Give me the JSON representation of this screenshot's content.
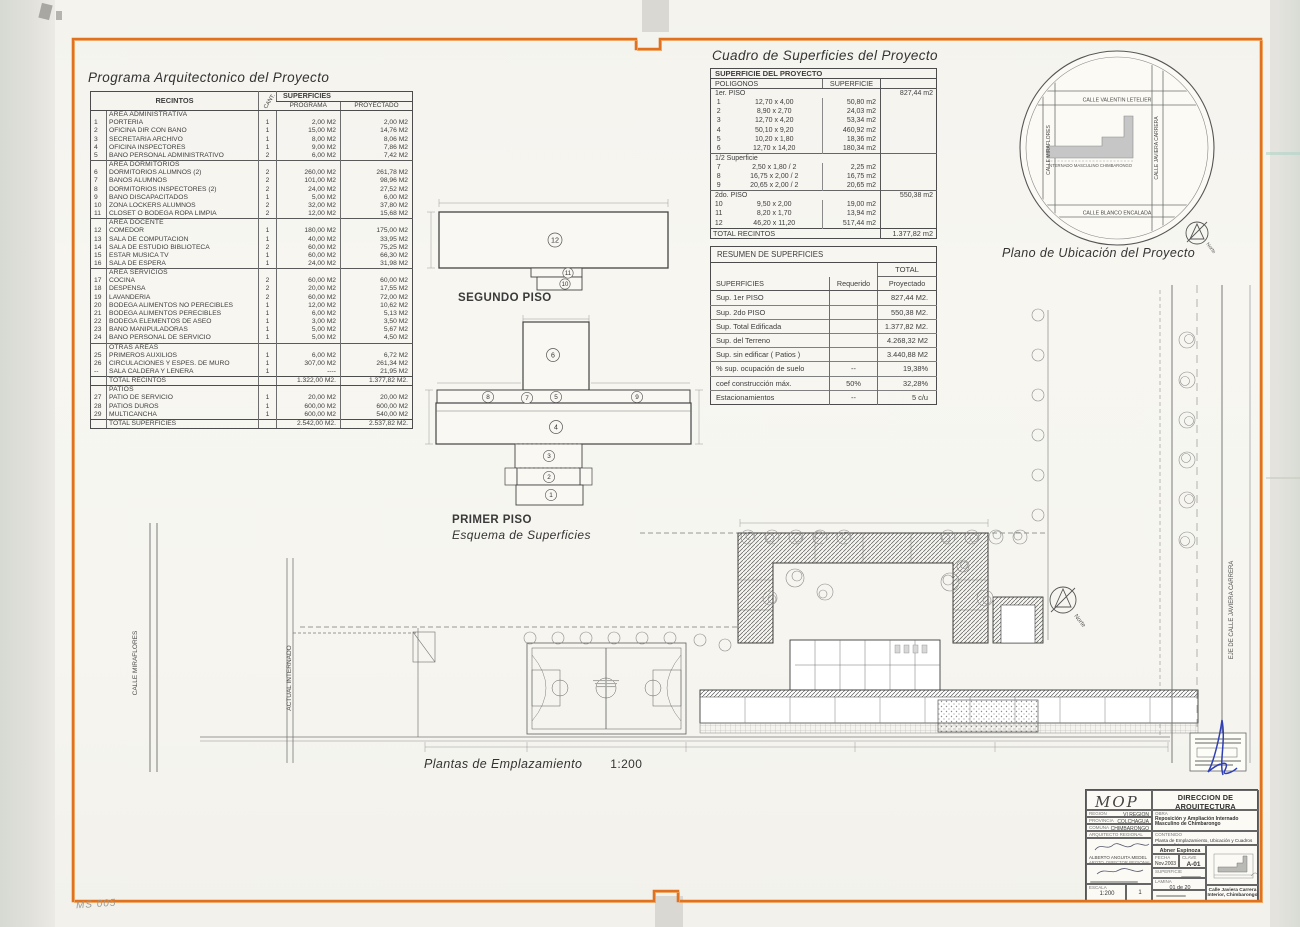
{
  "page": {
    "handwritten_mark": "MS 005"
  },
  "programa": {
    "title": "Programa Arquitectonico del Proyecto",
    "headers": {
      "recintos": "RECINTOS",
      "cant": "CANT.",
      "superficies": "SUPERFICIES",
      "programa": "PROGRAMA",
      "proyectado": "PROYECTADO"
    },
    "blocks": [
      {
        "name": "AREA ADMINISTRATIVA",
        "rows": [
          [
            "1",
            "PORTERIA",
            "1",
            "2,00 M2",
            "2,00 M2"
          ],
          [
            "2",
            "OFICINA DIR CON BAÑO",
            "1",
            "15,00 M2",
            "14,76 M2"
          ],
          [
            "3",
            "SECRETARIA ARCHIVO",
            "1",
            "8,00 M2",
            "8,06 M2"
          ],
          [
            "4",
            "OFICINA INSPECTORES",
            "1",
            "9,00 M2",
            "7,86 M2"
          ],
          [
            "5",
            "BAÑO PERSONAL ADMINISTRATIVO",
            "2",
            "6,00 M2",
            "7,42 M2"
          ]
        ]
      },
      {
        "name": "AREA DORMITORIOS",
        "rows": [
          [
            "6",
            "DORMITORIOS ALUMNOS  (2)",
            "2",
            "260,00 M2",
            "261,78 M2"
          ],
          [
            "7",
            "BAÑOS ALUMNOS",
            "2",
            "101,00 M2",
            "98,96 M2"
          ],
          [
            "8",
            "DORMITORIOS INSPECTORES  (2)",
            "2",
            "24,00 M2",
            "27,52 M2"
          ],
          [
            "9",
            "BAÑO DISCAPACITADOS",
            "1",
            "5,00 M2",
            "6,00 M2"
          ],
          [
            "10",
            "ZONA LOCKERS ALUMNOS",
            "2",
            "32,00 M2",
            "37,80 M2"
          ],
          [
            "11",
            "CLOSET O BODEGA ROPA LIMPIA",
            "2",
            "12,00 M2",
            "15,68 M2"
          ]
        ]
      },
      {
        "name": "AREA DOCENTE",
        "rows": [
          [
            "12",
            "COMEDOR",
            "1",
            "180,00 M2",
            "175,00 M2"
          ],
          [
            "13",
            "SALA DE COMPUTACION",
            "1",
            "40,00 M2",
            "33,95 M2"
          ],
          [
            "14",
            "SALA DE ESTUDIO BIBLIOTECA",
            "2",
            "60,00 M2",
            "75,25 M2"
          ],
          [
            "15",
            "ESTAR MUSICA TV",
            "1",
            "60,00 M2",
            "66,30 M2"
          ],
          [
            "16",
            "SALA DE ESPERA",
            "1",
            "24,00 M2",
            "31,98 M2"
          ]
        ]
      },
      {
        "name": "AREA SERVICIOS",
        "rows": [
          [
            "17",
            "COCINA",
            "2",
            "60,00 M2",
            "60,00 M2"
          ],
          [
            "18",
            "DESPENSA",
            "2",
            "20,00 M2",
            "17,55 M2"
          ],
          [
            "19",
            "LAVANDERIA",
            "2",
            "60,00 M2",
            "72,00 M2"
          ],
          [
            "20",
            "BODEGA ALIMENTOS NO PERECIBLES",
            "1",
            "12,00 M2",
            "10,62 M2"
          ],
          [
            "21",
            "BODEGA ALIMENTOS PERECIBLES",
            "1",
            "6,00 M2",
            "5,13 M2"
          ],
          [
            "22",
            "BODEGA ELEMENTOS DE ASEO",
            "1",
            "3,00 M2",
            "3,50 M2"
          ],
          [
            "23",
            "BAÑO MANIPULADORAS",
            "1",
            "5,00 M2",
            "5,67 M2"
          ],
          [
            "24",
            "BAÑO PERSONAL DE SERVICIO",
            "1",
            "5,00 M2",
            "4,50 M2"
          ]
        ]
      },
      {
        "name": "OTRAS AREAS",
        "rows": [
          [
            "25",
            "PRIMEROS AUXILIOS",
            "1",
            "6,00 M2",
            "6,72 M2"
          ],
          [
            "26",
            "CIRCULACIONES Y ESPES. DE MURO",
            "1",
            "307,00 M2",
            "261,34 M2"
          ],
          [
            "--",
            "SALA CALDERA Y LEÑERA",
            "1",
            "----",
            "21,95 M2"
          ]
        ]
      },
      {
        "label": "TOTAL RECINTOS",
        "programa": "1.322,00 M2.",
        "proyectado": "1.377,82 M2."
      },
      {
        "name": "PATIOS",
        "rows": [
          [
            "27",
            "PATIO DE SERVICIO",
            "1",
            "20,00 M2",
            "20,00 M2"
          ],
          [
            "28",
            "PATIOS DUROS",
            "1",
            "600,00 M2",
            "600,00 M2"
          ],
          [
            "29",
            "MULTICANCHA",
            "1",
            "600,00 M2",
            "540,00 M2"
          ]
        ]
      },
      {
        "label": "TOTAL SUPERFICIES",
        "programa": "2.542,00 M2.",
        "proyectado": "2.537,82 M2."
      }
    ]
  },
  "cuadro": {
    "title": "Cuadro de Superficies del Proyecto",
    "table_title": "SUPERFICIE DEL PROYECTO",
    "col_poligonos": "POLIGONOS",
    "col_superficie": "SUPERFICIE",
    "groups": [
      {
        "name": "1er.  PISO",
        "total": "827,44 m2",
        "rows": [
          [
            "1",
            "12,70 x 4,00",
            "50,80 m2"
          ],
          [
            "2",
            "8,90 x 2,70",
            "24,03 m2"
          ],
          [
            "3",
            "12,70 x 4,20",
            "53,34 m2"
          ],
          [
            "4",
            "50,10 x 9,20",
            "460,92 m2"
          ],
          [
            "5",
            "10,20 x 1,80",
            "18,36 m2"
          ],
          [
            "6",
            "12,70 x 14,20",
            "180,34 m2"
          ]
        ]
      },
      {
        "name": "1/2 Superficie",
        "total": "",
        "rows": [
          [
            "7",
            "2,50 x 1,80 / 2",
            "2,25 m2"
          ],
          [
            "8",
            "16,75 x 2,00 / 2",
            "16,75 m2"
          ],
          [
            "9",
            "20,65 x 2,00 / 2",
            "20,65 m2"
          ]
        ]
      },
      {
        "name": "2do.  PISO",
        "total": "550,38 m2",
        "rows": [
          [
            "10",
            "9,50 x 2,00",
            "19,00 m2"
          ],
          [
            "11",
            "8,20 x 1,70",
            "13,94 m2"
          ],
          [
            "12",
            "46,20 x 11,20",
            "517,44 m2"
          ]
        ]
      }
    ],
    "total": {
      "label": "TOTAL RECINTOS",
      "value": "1.377,82 m2"
    }
  },
  "resumen": {
    "title": "RESUMEN DE SUPERFICIES",
    "total_header": "TOTAL",
    "col_superficies": "SUPERFICIES",
    "col_requerido": "Requerido",
    "col_proyectado": "Proyectado",
    "rows": [
      [
        "Sup. 1er PISO",
        "",
        "827,44 M2."
      ],
      [
        "Sup. 2do PISO",
        "",
        "550,38 M2."
      ],
      [
        "Sup. Total Edificada",
        "",
        "1.377,82 M2."
      ],
      [
        "Sup. del Terreno",
        "",
        "4.268,32 M2"
      ],
      [
        "Sup. sin edificar ( Patios )",
        "",
        "3.440,88 M2"
      ],
      [
        "% sup. ocupación de suelo",
        "--",
        "19,38%"
      ],
      [
        "coef construcción máx.",
        "50%",
        "32,28%"
      ],
      [
        "Estacionamientos",
        "--",
        "5 c/u"
      ]
    ]
  },
  "ubicacion": {
    "label": "Plano de Ubicación del Proyecto",
    "street_top": "CALLE  VALENTIN LETELIER",
    "street_bottom": "CALLE  BLANCO ENCALADA",
    "street_left": "CALLE  MIRAFLORES",
    "street_right": "CALLE  JAVIERA CARRERA",
    "building_label": "INTERNADO MASCULINO CHIMBARONGO",
    "north_label": "Norte"
  },
  "esquemas": {
    "segundo_piso": {
      "label": "SEGUNDO PISO",
      "numbers": [
        "12",
        "11",
        "10"
      ]
    },
    "primer_piso": {
      "label": "PRIMER PISO",
      "sublabel": "Esquema de Superficies",
      "numbers": [
        "6",
        "8",
        "7",
        "5",
        "9",
        "4",
        "3",
        "2",
        "1"
      ]
    }
  },
  "emplazamiento": {
    "label": "Plantas de Emplazamiento",
    "scale": "1:200",
    "calle_miraflores": "CALLE MIRAFLORES",
    "actual_internado": "ACTUAL INTERNADO",
    "eje_calle": "EJE DE CALLE JAVIERA CARRERA",
    "north_label": "Norte"
  },
  "titleblock": {
    "logo": "MOP",
    "dir1": "DIRECCION DE ARQUITECTURA",
    "dir2": "OFICINA  REGIONAL  VI REGION",
    "region_label": "REGION",
    "region_value": "VI REGION",
    "provincia_label": "PROVINCIA",
    "provincia_value": "COLCHAGUA",
    "comuna_label": "COMUNA",
    "comuna_value": "CHIMBARONGO",
    "arquitecto_label": "ARQUITECTO REGIONAL",
    "firma1_name": "ALBERTO ANGUITA MEDEL",
    "firma1_cargo": "ARQTO. DIRECTOR REGIONAL",
    "obra_label": "OBRA",
    "obra_value": "Reposición y Ampliación Internado Masculino de Chimbarongo",
    "contenido_label": "CONTENIDO",
    "contenido_value": "Planta de Emplazamiento, Ubicación y Cuadros de Superficies",
    "dibujante": "Abner Espinoza",
    "fecha_label": "FECHA",
    "fecha_value": "Nov.2003",
    "clave_label": "CLAVE",
    "clave_value": "A-01",
    "superficie_label": "SUPERFICIE",
    "lamina_label": "LAMINA",
    "lamina_value": "01 de 20",
    "escala_label": "ESCALA",
    "escala_value": "1:200",
    "copia": "1",
    "address1": "Calle Javiera Carrera",
    "address2": "Interior, Chimbarongo"
  }
}
